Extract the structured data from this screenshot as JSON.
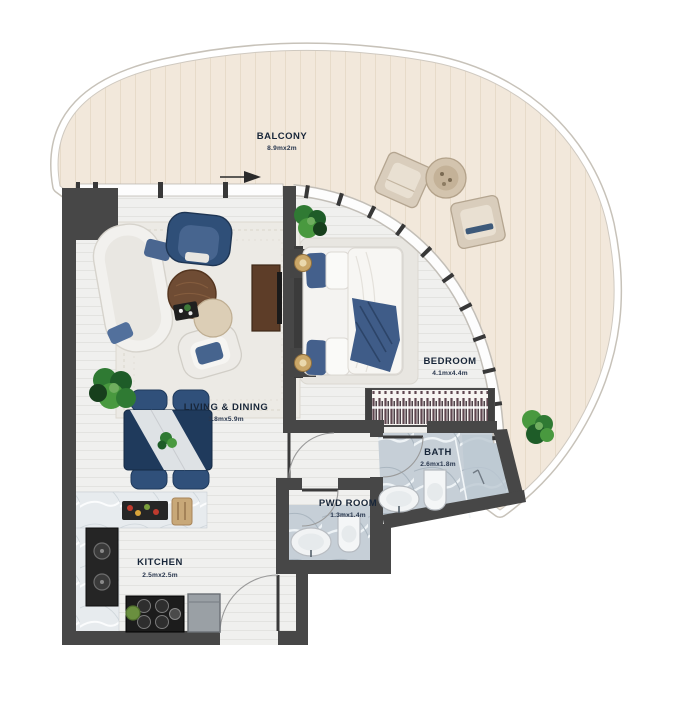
{
  "plan": {
    "type": "apartment-floor-plan",
    "rooms": {
      "balcony": {
        "name": "BALCONY",
        "dims": "8.9mx2m"
      },
      "living": {
        "name": "LIVING & DINING",
        "dims": "3.8mx5.9m"
      },
      "bedroom": {
        "name": "BEDROOM",
        "dims": "4.1mx4.4m"
      },
      "bath": {
        "name": "BATH",
        "dims": "2.6mx1.8m"
      },
      "pwd": {
        "name": "PWD ROOM",
        "dims": "1.3mx1.4m"
      },
      "kitchen": {
        "name": "KITCHEN",
        "dims": "2.5mx2.5m"
      }
    },
    "palette": {
      "wall": "#474747",
      "interior_floor": "#f0f0ee",
      "balcony_floor": "#f2e8db",
      "marble_bath": "#c6cfd7",
      "navy_furniture": "#35557f",
      "wood": "#6f4c34",
      "label_text": "#182639",
      "plant_green": "#2f7a33"
    },
    "furniture_icons": [
      "sofa",
      "lounge-armchair",
      "accent-chair",
      "coffee-table",
      "side-table",
      "serving-tray",
      "dining-table",
      "dining-chair",
      "tv-console",
      "double-bed",
      "bedside-lamp",
      "wardrobe",
      "toilet",
      "washbasin",
      "shower",
      "counter",
      "kitchen-sink",
      "cutting-board",
      "cooktop",
      "fridge",
      "outdoor-lounge-chair",
      "outdoor-side-table",
      "potted-plant",
      "sliding-door-arrow-icon"
    ]
  }
}
